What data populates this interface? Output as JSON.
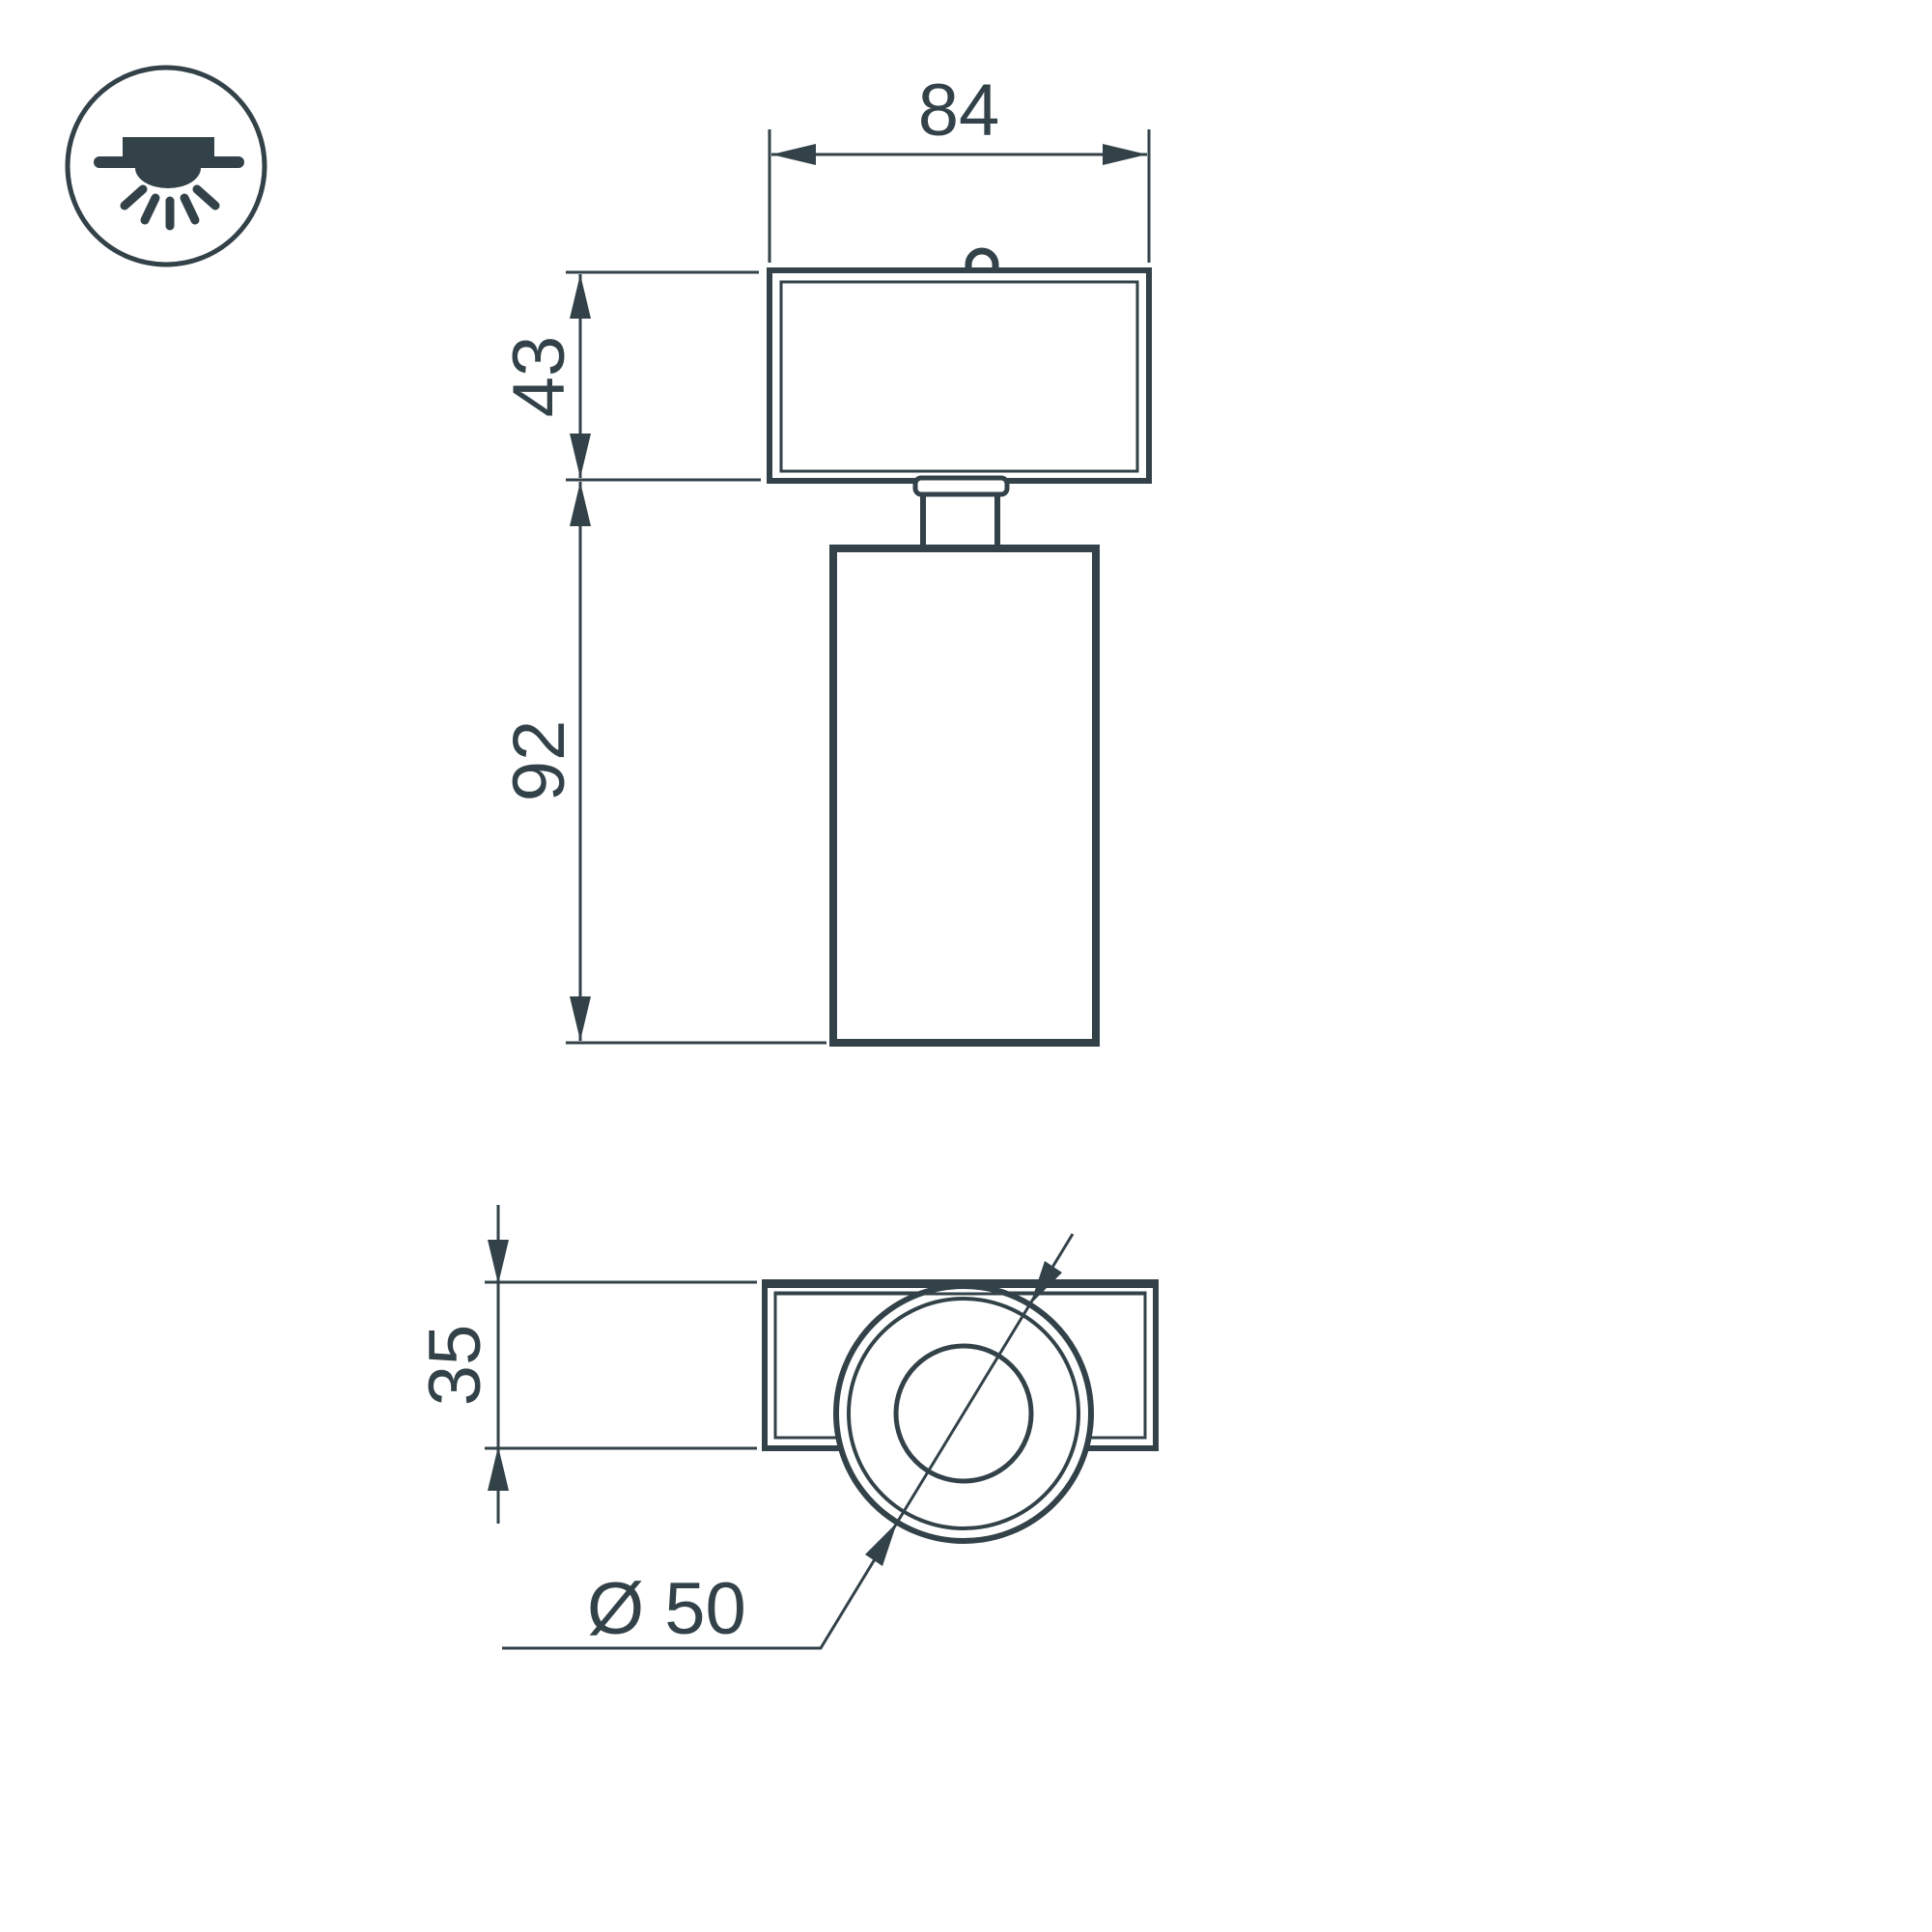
{
  "drawing": {
    "type": "technical-dimension-drawing",
    "subject": "surface-mounted ceiling spot luminaire, front view and bottom view",
    "labels": {
      "width": "84",
      "adapter_height": "43",
      "body_height": "92",
      "base_depth": "35",
      "diameter": "Ø 50"
    },
    "icon": {
      "name": "surface-ceiling-downlight-icon"
    },
    "colors": {
      "line": "#334249",
      "background": "#ffffff"
    }
  }
}
